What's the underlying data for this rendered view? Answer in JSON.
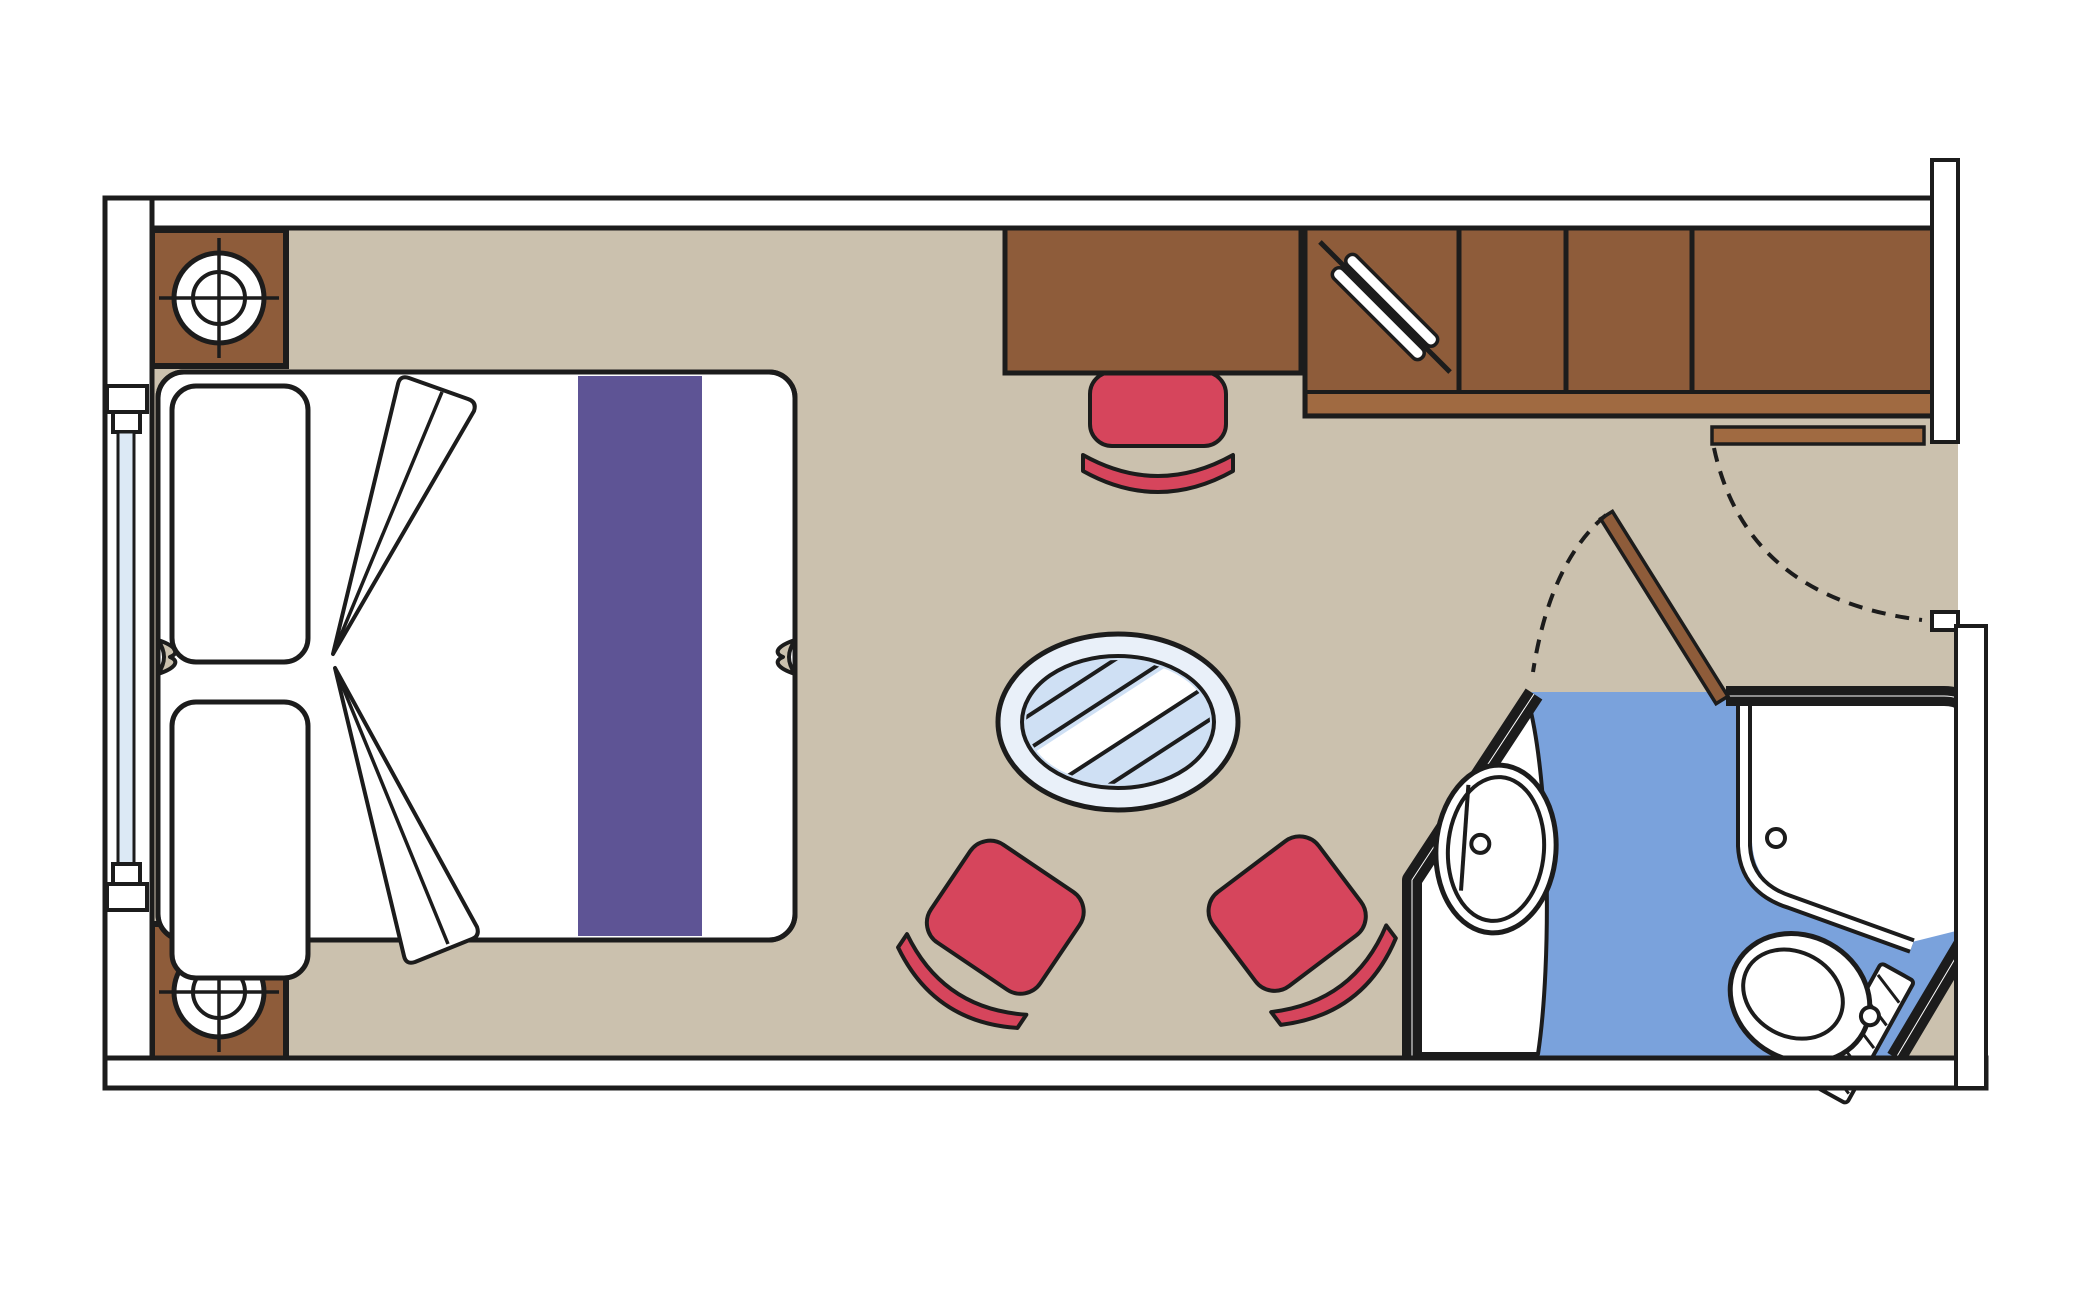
{
  "meta": {
    "type": "floor-plan",
    "subject": "Cruise ship cabin floor plan, top-down view",
    "view": "overhead 2D plan, no text labels visible"
  },
  "colors": {
    "floor": "#CBC1AE",
    "wall": "#FFFFFF",
    "outline": "#1C1C1C",
    "wood": "#8E5C3A",
    "wood_light": "#A06A41",
    "upholstery": "#D6455C",
    "runner": "#5E5495",
    "window_glass": "#DCE9F5",
    "table_ring": "#E9F0F9",
    "table_glass": "#CFE0F4",
    "bath_floor": "#7AA2DC"
  },
  "rooms": {
    "cabin": "Main cabin",
    "bathroom": "Bathroom with sink, shower and toilet",
    "entry": "Entrance vestibule"
  },
  "furniture": {
    "window": "Window wall (cabin exterior side)",
    "nightstand_top": "Nightstand with lamp",
    "nightstand_bottom": "Nightstand with lamp",
    "bed": "Double bed (two convertible singles)",
    "pillow": "Pillow",
    "duvet_fold": "Folded duvet",
    "runner": "Bed runner",
    "desk": "Desk / vanity",
    "desk_chair": "Desk chair",
    "wardrobe": "Wardrobe with hanging rail",
    "hanger_rail": "Hanging rail",
    "entrance_door": "Cabin entrance door with swing",
    "bathroom_door": "Bathroom door with swing",
    "table": "Round glass table",
    "chair_left": "Armchair",
    "chair_right": "Armchair",
    "sink": "Washbasin on counter",
    "shower": "Shower enclosure with drain",
    "toilet": "Toilet with cistern"
  }
}
